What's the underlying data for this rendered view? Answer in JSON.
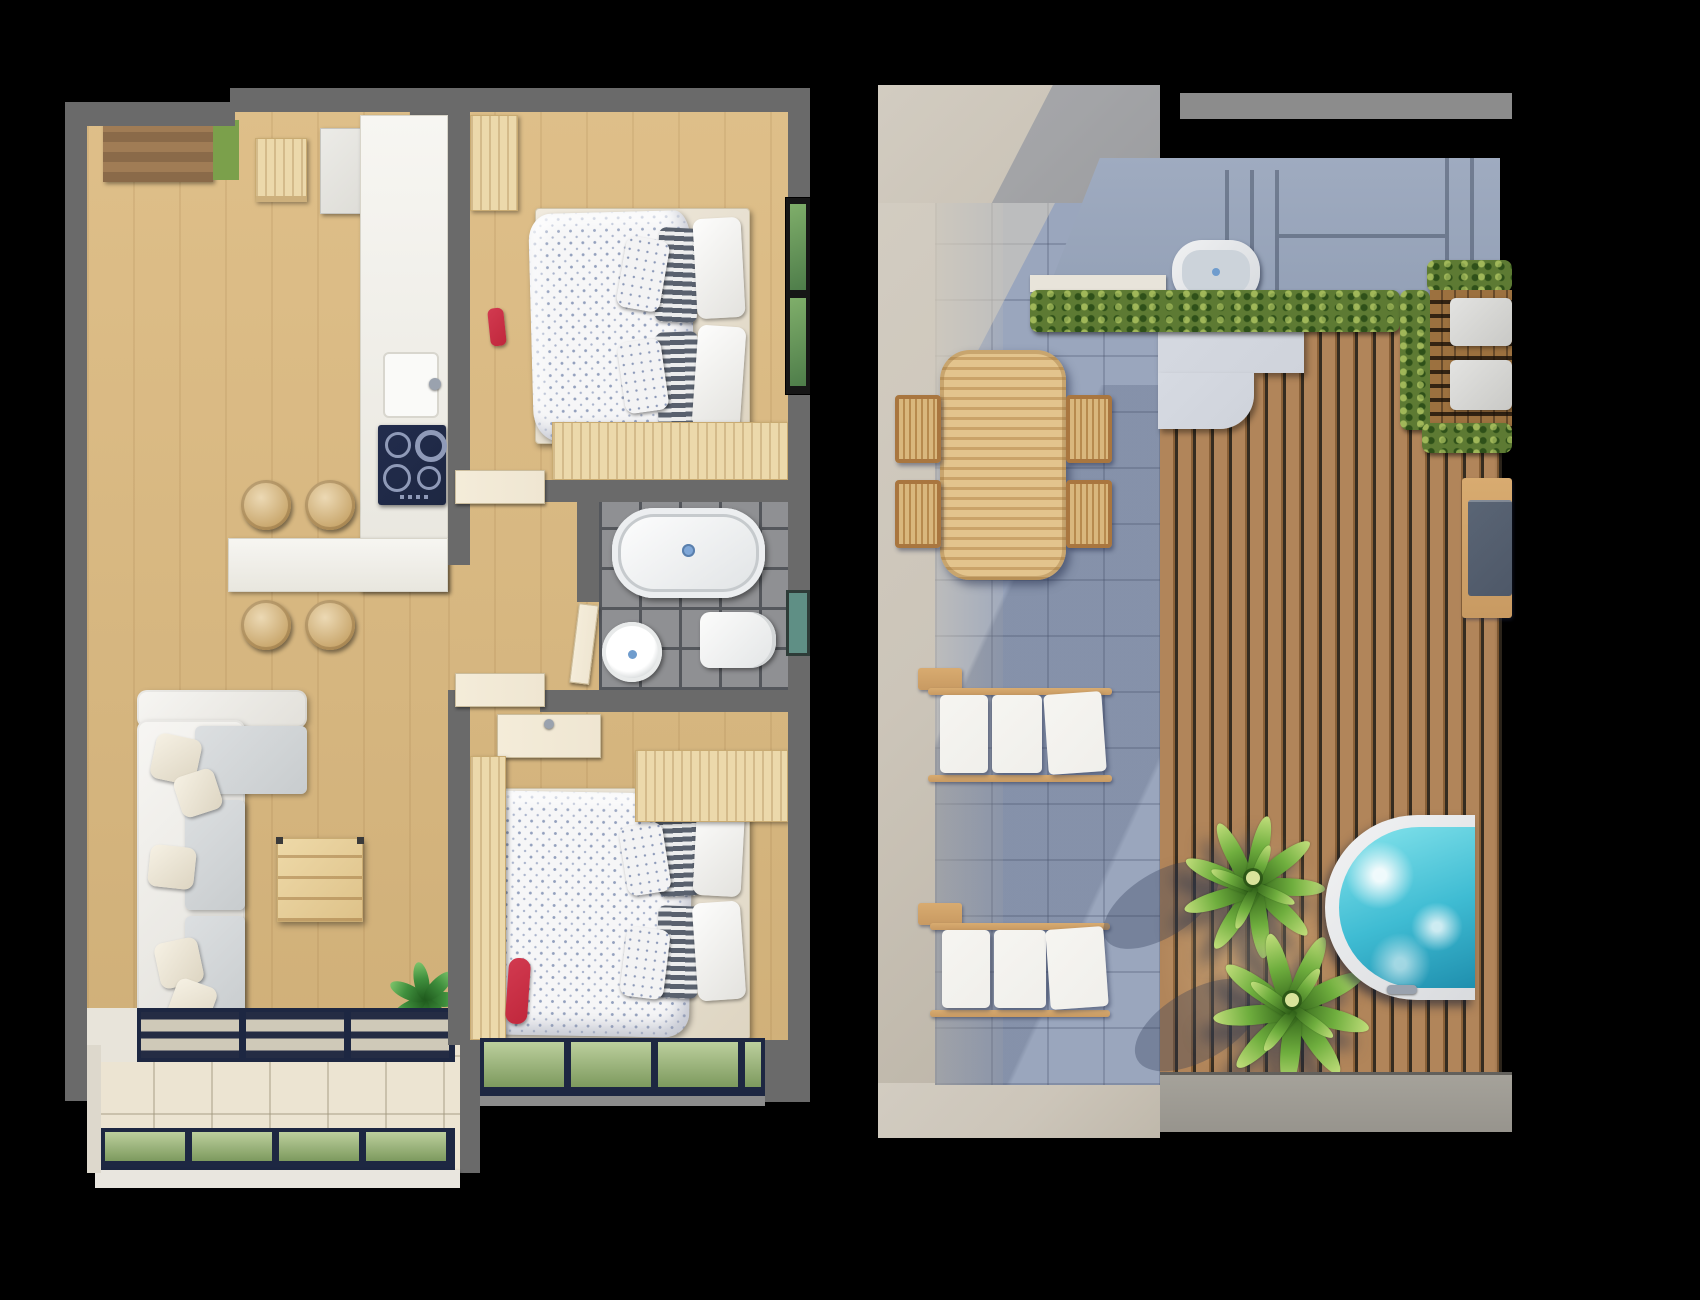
{
  "meta": {
    "description": "Two top-down 3D architectural floor-plan renders on a black background: left is a furnished apartment interior, right is a roof terrace with deck, loungers and hot tub",
    "canvas": {
      "width": 1700,
      "height": 1300
    }
  },
  "palette": {
    "bg": "#000000",
    "wall": "#6a6a6a",
    "wood-floor": "#dcba80",
    "pine": "#ecd9ab",
    "counter": "#f2f0ea",
    "navy": "#1d2742",
    "cream-tile": "#ece4d2",
    "bath-tile": "#8f9093",
    "grout": "#54575c",
    "glass-green": "#7d9a5e",
    "window-green": "#4e7d4a",
    "teal-window": "#5f8f85",
    "door-cream": "#efe6d2",
    "red-accent": "#c0273c",
    "plant-green": "#3f8f3d",
    "steel": "#9aa2ae",
    "concrete": "#ccc5b9",
    "terrace-tile": "#9aa6bd",
    "steps": "#93a0b6",
    "hedge": "#5d7a33",
    "deck": "#b1855a",
    "deck-gap": "#352c20",
    "grate": "#9c713f",
    "landing": "#cfd3db",
    "lounger-wood": "#c89a62",
    "cushion-white": "#f0efeb",
    "bench-cushion": "#4e5868",
    "tub-water": "#3fbcd3",
    "palm-green": "#6fae3e",
    "palm-dark": "#3f7320",
    "ledge-gray": "#97948d"
  },
  "left_plan": {
    "title": "Apartment floor plan — interior level (top-down 3D render)",
    "rooms": {
      "entry": {
        "label": "Entry hall"
      },
      "kitchen": {
        "label": "Kitchen"
      },
      "living_room": {
        "label": "Living room"
      },
      "bedroom_top": {
        "label": "Bedroom 1"
      },
      "bedroom_bottom": {
        "label": "Bedroom 2"
      },
      "bathroom": {
        "label": "Bathroom"
      },
      "hallway": {
        "label": "Hallway"
      },
      "balcony": {
        "label": "Balcony"
      }
    },
    "items": {
      "door_mat": {
        "label": "Entry wood mat"
      },
      "green_mat": {
        "label": "Green door mat"
      },
      "shoe_shelf": {
        "label": "Entry shelf"
      },
      "closet": {
        "label": "Entry closet"
      },
      "counter": {
        "label": "Kitchen counter"
      },
      "sink": {
        "label": "Kitchen sink"
      },
      "cooktop": {
        "label": "Cooktop with four burners"
      },
      "island": {
        "label": "Breakfast bar"
      },
      "stool": {
        "label": "Round wooden stool"
      },
      "sofa": {
        "label": "L-shaped sofa"
      },
      "chaise": {
        "label": "Chaise section"
      },
      "pillow": {
        "label": "Sofa pillow"
      },
      "coffee_table": {
        "label": "Square wooden coffee table"
      },
      "plant": {
        "label": "Potted green plant"
      },
      "sliding_door": {
        "label": "Sliding glass balcony door"
      },
      "bed": {
        "label": "Double bed with patterned duvet"
      },
      "wardrobe": {
        "label": "Wooden wardrobe"
      },
      "cabinet": {
        "label": "Wooden cabinet"
      },
      "red_chair": {
        "label": "Red accent chair"
      },
      "shower": {
        "label": "Shower tray"
      },
      "toilet": {
        "label": "Toilet"
      },
      "basin": {
        "label": "Round washbasin"
      },
      "vanity": {
        "label": "Hall washbasin unit"
      },
      "bath_door": {
        "label": "Bathroom door"
      },
      "window": {
        "label": "Window"
      },
      "railing": {
        "label": "Glass balcony railing"
      }
    }
  },
  "right_plan": {
    "title": "Roof terrace floor plan (top-down 3D render)",
    "zones": {
      "patio": {
        "label": "Tiled patio"
      },
      "deck": {
        "label": "Timber deck"
      },
      "steps": {
        "label": "Concrete steps"
      },
      "planter": {
        "label": "Hedge planter"
      },
      "alcove": {
        "label": "Timber-grate alcove"
      },
      "ledge": {
        "label": "Concrete ledge"
      }
    },
    "items": {
      "dining_table": {
        "label": "Slatted outdoor dining table"
      },
      "chair": {
        "label": "Slatted outdoor chair"
      },
      "lounger": {
        "label": "Sun lounger with white cushions"
      },
      "side_table": {
        "label": "Lounger side table"
      },
      "outdoor_tub": {
        "label": "Outdoor bathtub"
      },
      "deck_bench": {
        "label": "Deck bench with gray cushion"
      },
      "alcove_bench": {
        "label": "Alcove bench"
      },
      "hot_tub": {
        "label": "Semicircular hot tub"
      },
      "palm": {
        "label": "Palm tree"
      },
      "landing": {
        "label": "Concrete landing"
      }
    }
  }
}
